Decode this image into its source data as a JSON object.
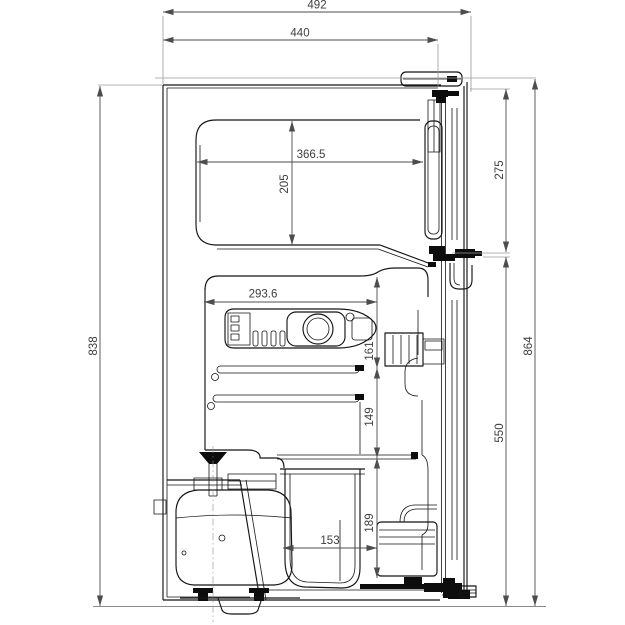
{
  "dimensions": {
    "total_depth": "492",
    "cabinet_depth": "440",
    "cabinet_height": "838",
    "total_height": "864",
    "freezer_door_height": "275",
    "fridge_door_height": "550",
    "freezer_interior_depth": "366.5",
    "freezer_interior_height": "205",
    "fridge_interior_depth": "293.6",
    "upper_section_height": "161",
    "middle_section_height": "149",
    "lower_section_height": "189",
    "crisper_depth": "153"
  },
  "colors": {
    "object_line": "#141414",
    "dimension_line": "#4d4d4d",
    "dimension_text": "#3d3d3d",
    "extension_line": "#9a9a9a",
    "background": "#ffffff"
  }
}
